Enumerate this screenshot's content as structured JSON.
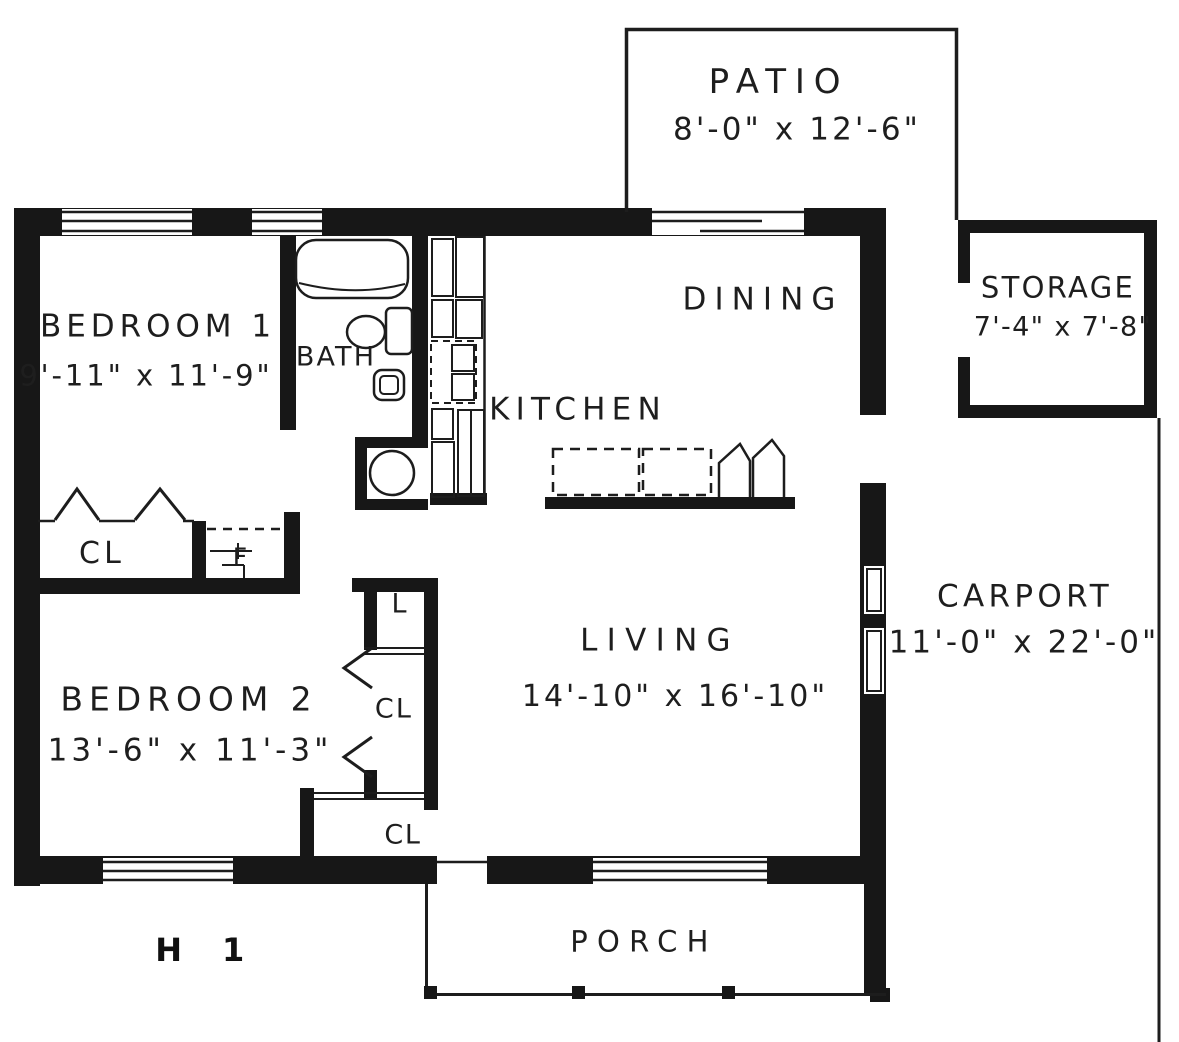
{
  "drawing": {
    "figure_label": "H 1",
    "rooms": {
      "patio": {
        "name": "PATIO",
        "dims": "8'-0\" x 12'-6\""
      },
      "storage": {
        "name": "STORAGE",
        "dims": "7'-4\" x 7'-8\""
      },
      "bedroom1": {
        "name": "BEDROOM 1",
        "dims": "9'-11\" x 11'-9\""
      },
      "bath": {
        "name": "BATH"
      },
      "kitchen": {
        "name": "KITCHEN"
      },
      "dining": {
        "name": "DINING"
      },
      "living": {
        "name": "LIVING",
        "dims": "14'-10\" x 16'-10\""
      },
      "bedroom2": {
        "name": "BEDROOM 2",
        "dims": "13'-6\" x 11'-3\""
      },
      "carport": {
        "name": "CARPORT",
        "dims": "11'-0\" x 22'-0\""
      },
      "porch": {
        "name": "PORCH"
      },
      "closet_bedroom1": {
        "name": "CL"
      },
      "closet_bedroom2": {
        "name": "CL"
      },
      "closet_entry": {
        "name": "CL"
      },
      "linen": {
        "name": "L"
      },
      "furnace": {
        "name": "F"
      }
    },
    "colors": {
      "ink": "#171717",
      "paper": "#ffffff"
    }
  }
}
